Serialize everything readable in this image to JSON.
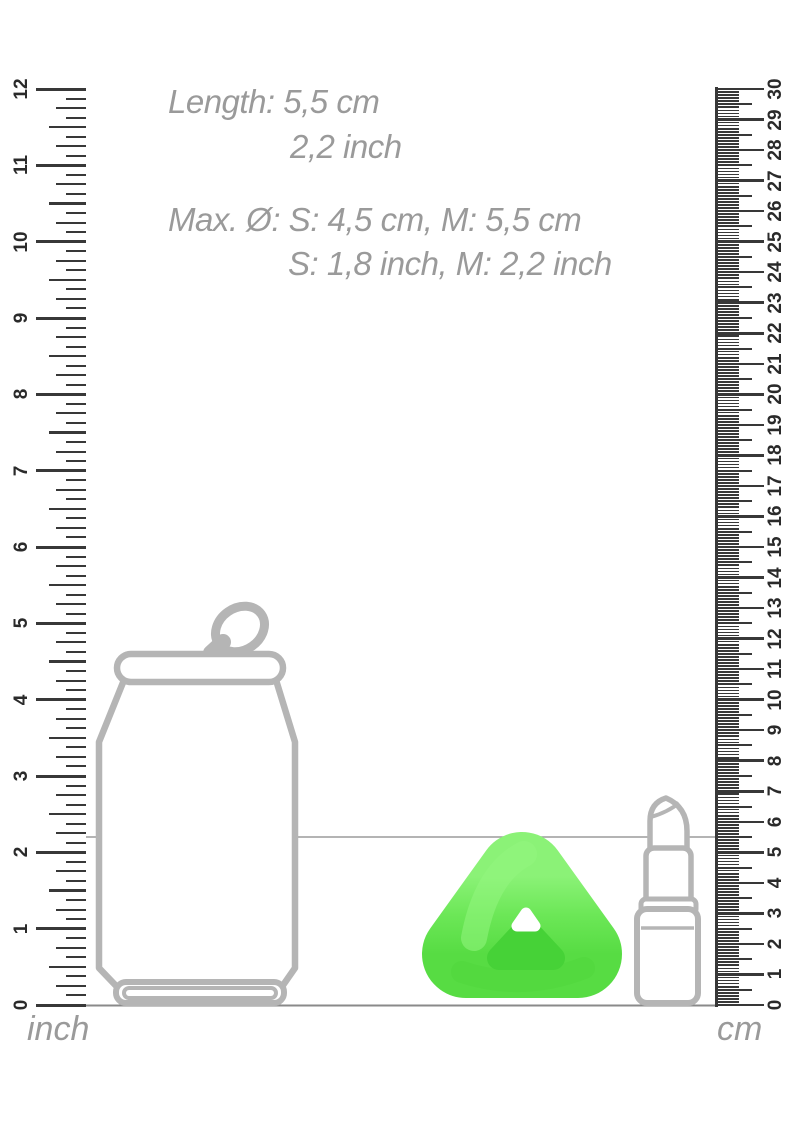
{
  "annotations": {
    "length": {
      "line1": "Length: 5,5 cm",
      "line2": "2,2 inch"
    },
    "diameter": {
      "line1": "Max. Ø: S: 4,5 cm, M: 5,5 cm",
      "line2": "S: 1,8 inch, M: 2,2 inch"
    }
  },
  "rulers": {
    "left": {
      "unit_label": "inch",
      "min": 0,
      "max": 12,
      "subdivisions_per_unit": 8,
      "tick_labels": [
        "0",
        "1",
        "2",
        "3",
        "4",
        "5",
        "6",
        "7",
        "8",
        "9",
        "10",
        "11",
        "12"
      ]
    },
    "right": {
      "unit_label": "cm",
      "min": 0,
      "max": 30,
      "subdivisions_per_unit": 10,
      "tick_labels": [
        "0",
        "1",
        "2",
        "3",
        "4",
        "5",
        "6",
        "7",
        "8",
        "9",
        "10",
        "11",
        "12",
        "13",
        "14",
        "15",
        "16",
        "17",
        "18",
        "19",
        "20",
        "21",
        "22",
        "23",
        "24",
        "25",
        "26",
        "27",
        "28",
        "29",
        "30"
      ]
    }
  },
  "reference_line": {
    "at_cm": 5.5,
    "at_inch": 2.2
  },
  "objects": {
    "can": {
      "name": "soda-can-outline"
    },
    "product": {
      "name": "triangle-ring-product",
      "color": "#6ee95a"
    },
    "lipstick": {
      "name": "lipstick-outline"
    }
  },
  "colors": {
    "annotation_text": "#9a9a9a",
    "ruler_tick": "#383838",
    "ruler_number": "#2a2a2a",
    "outline_gray": "#b5b5b5",
    "product_green": "#6ee95a",
    "product_green_dark": "#46d237",
    "reference_line": "#9b9b9b",
    "ground_line": "#8a8a8a"
  }
}
